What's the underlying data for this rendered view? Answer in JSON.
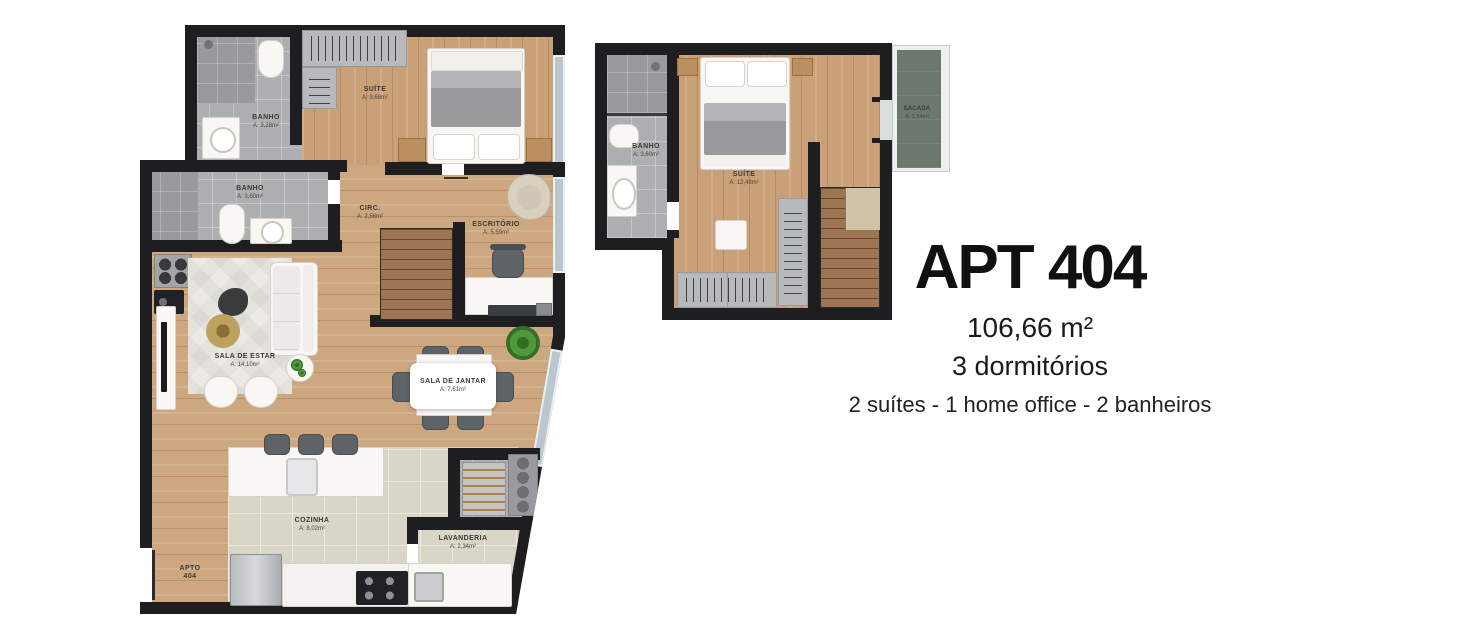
{
  "info": {
    "title": "APT 404",
    "area": "106,66 m²",
    "bedrooms": "3 dormitórios",
    "features": "2 suítes - 1 home office - 2 banheiros"
  },
  "left": {
    "name": "Planta pavimento inferior",
    "rooms": {
      "banho1": {
        "label": "BANHO",
        "area": "A: 3,28m²"
      },
      "suite": {
        "label": "SUÍTE",
        "area": "A: 9,68m²"
      },
      "banho2": {
        "label": "BANHO",
        "area": "A: 3,60m²"
      },
      "circ": {
        "label": "CIRC.",
        "area": "A: 2,56m²"
      },
      "escritorio": {
        "label": "ESCRITÓRIO",
        "area": "A: 5,59m²"
      },
      "sala_estar": {
        "label": "SALA DE ESTAR",
        "area": "A: 14,10m²"
      },
      "sala_jantar": {
        "label": "SALA DE JANTAR",
        "area": "A: 7,61m²"
      },
      "cozinha": {
        "label": "COZINHA",
        "area": "A: 8,02m²"
      },
      "lavanderia": {
        "label": "LAVANDERIA",
        "area": "A: 2,34m²"
      },
      "apto": {
        "line1": "APTO",
        "line2": "404"
      }
    }
  },
  "right": {
    "name": "Planta pavimento superior",
    "rooms": {
      "banho": {
        "label": "BANHO",
        "area": "A: 3,60m²"
      },
      "suite": {
        "label": "SUÍTE",
        "area": "A: 12,48m²"
      },
      "sacada": {
        "label": "SACADA",
        "area": "A: 1,54m²"
      }
    }
  },
  "colors": {
    "wall": "#1e1e20",
    "wood_floor": "#cda77f",
    "bath_tile": "#aeafb1",
    "kitchen_tile": "#d9d6c8",
    "balcony_floor": "#6d786e",
    "stairs": "#9d7552",
    "title_text": "#111111"
  }
}
